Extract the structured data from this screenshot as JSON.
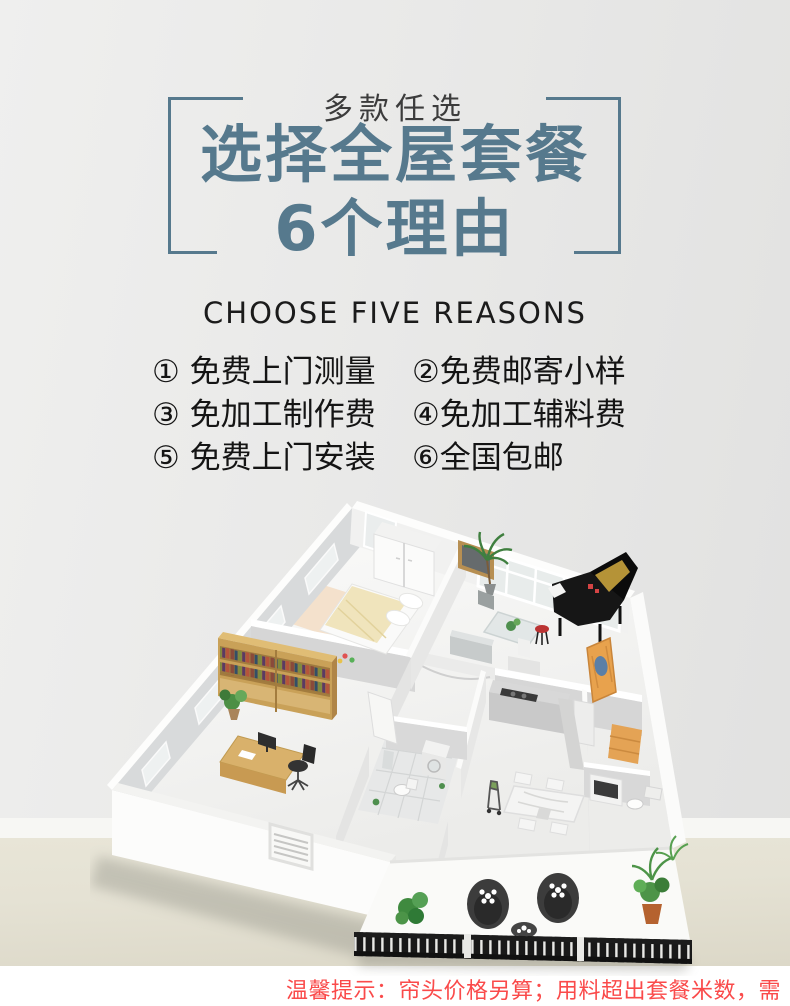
{
  "theme": {
    "accent": "#56798d",
    "eyebrow": "#3c3c3c",
    "text-dark": "#141414",
    "note-red": "#fa4a4a",
    "bg-light": "#efefee",
    "bg-dark": "#e1e1e0",
    "floor-beige": "#e5e2d4",
    "band-white": "#ffffff"
  },
  "header": {
    "eyebrow": "多款任选",
    "title_line1": "选择全屋套餐",
    "title_line2": "6个理由",
    "subtitle_en": "CHOOSE FIVE REASONS",
    "title_color": "#56798d",
    "bracket_color": "#56798d"
  },
  "reasons": {
    "items": [
      {
        "label": "① 免费上门测量"
      },
      {
        "label": "②免费邮寄小样"
      },
      {
        "label": "③ 免加工制作费"
      },
      {
        "label": "④免加工辅料费"
      },
      {
        "label": "⑤ 免费上门安装"
      },
      {
        "label": "⑥全国包邮"
      }
    ]
  },
  "floorplan": {
    "kind": "isometric 3D apartment render",
    "depicted": [
      "bedroom-bed",
      "wardrobe",
      "wall-mirror",
      "grand-piano",
      "piano-stool",
      "french-windows",
      "palm-plant",
      "glass-coffee-table",
      "bookshelf",
      "study-desk",
      "office-chair",
      "bathroom-tiles",
      "washing-machine",
      "toilet",
      "kitchen-counter",
      "range-hood",
      "cooktop",
      "dining-table",
      "dining-chairs",
      "baby-chair",
      "orange-door",
      "tv-cabinet",
      "balcony-egg-chairs",
      "balcony-table",
      "balcony-plants",
      "balcony-railing",
      "front-wall-window"
    ]
  },
  "footer": {
    "note": "温馨提示：帘头价格另算；用料超出套餐米数，需补差价",
    "color": "#fa4a4a"
  }
}
